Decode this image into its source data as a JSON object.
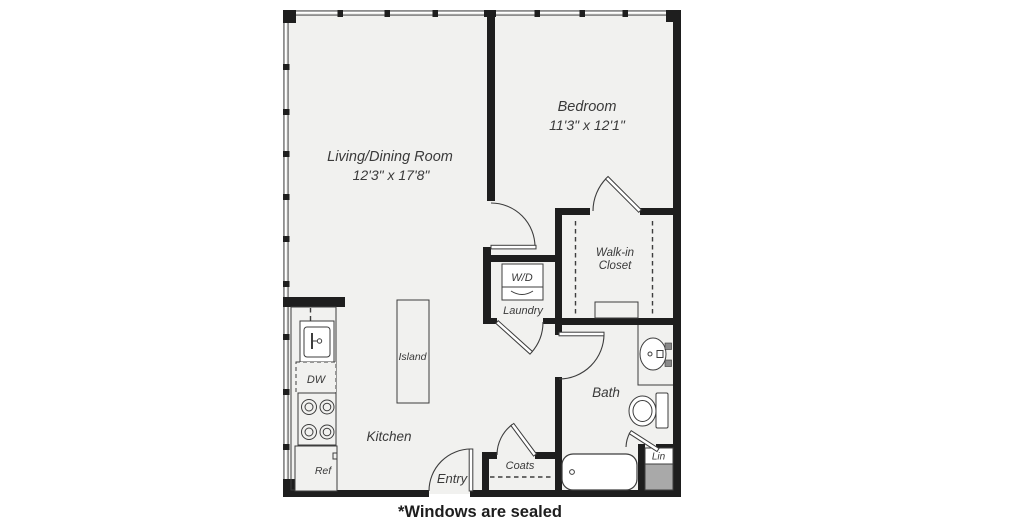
{
  "plan": {
    "rooms": {
      "living_dining": {
        "name": "Living/Dining Room",
        "dimensions": "12'3\" x 17'8\""
      },
      "bedroom": {
        "name": "Bedroom",
        "dimensions": "11'3\" x 12'1\""
      },
      "walk_in_closet": {
        "line1": "Walk-in",
        "line2": "Closet"
      },
      "laundry": {
        "name": "Laundry"
      },
      "bath": {
        "name": "Bath"
      },
      "kitchen": {
        "name": "Kitchen"
      },
      "entry": {
        "name": "Entry"
      },
      "coats": {
        "name": "Coats"
      },
      "linen": {
        "name": "Lin"
      }
    },
    "fixtures": {
      "washer_dryer": "W/D",
      "dishwasher": "DW",
      "refrigerator": "Ref",
      "island": "Island"
    },
    "footnote": "*Windows are sealed",
    "colors": {
      "wall": "#1e1e1e",
      "floor": "#f1f1ef",
      "window": "#8e8e8e",
      "fixture_stroke": "#3d3d3d",
      "label": "#3a3a3a",
      "shaft_fill": "#a9a9a9"
    }
  }
}
